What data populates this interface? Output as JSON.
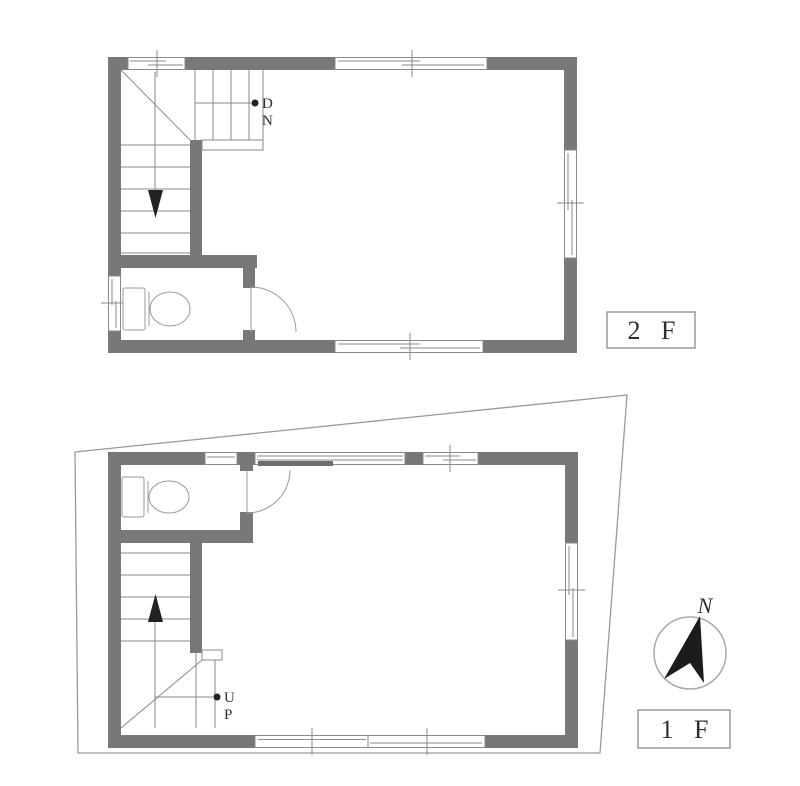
{
  "colors": {
    "background": "#ffffff",
    "wall_fill": "#787878",
    "line": "#8a8a8a",
    "text": "#2f2f2f",
    "compass_arrow": "#1c1c1c"
  },
  "floor_2": {
    "label": "2 F",
    "stair_marker": {
      "line1": "D",
      "line2": "N"
    }
  },
  "floor_1": {
    "label": "1 F",
    "stair_marker": {
      "line1": "U",
      "line2": "P"
    }
  },
  "compass": {
    "north_label": "N"
  }
}
